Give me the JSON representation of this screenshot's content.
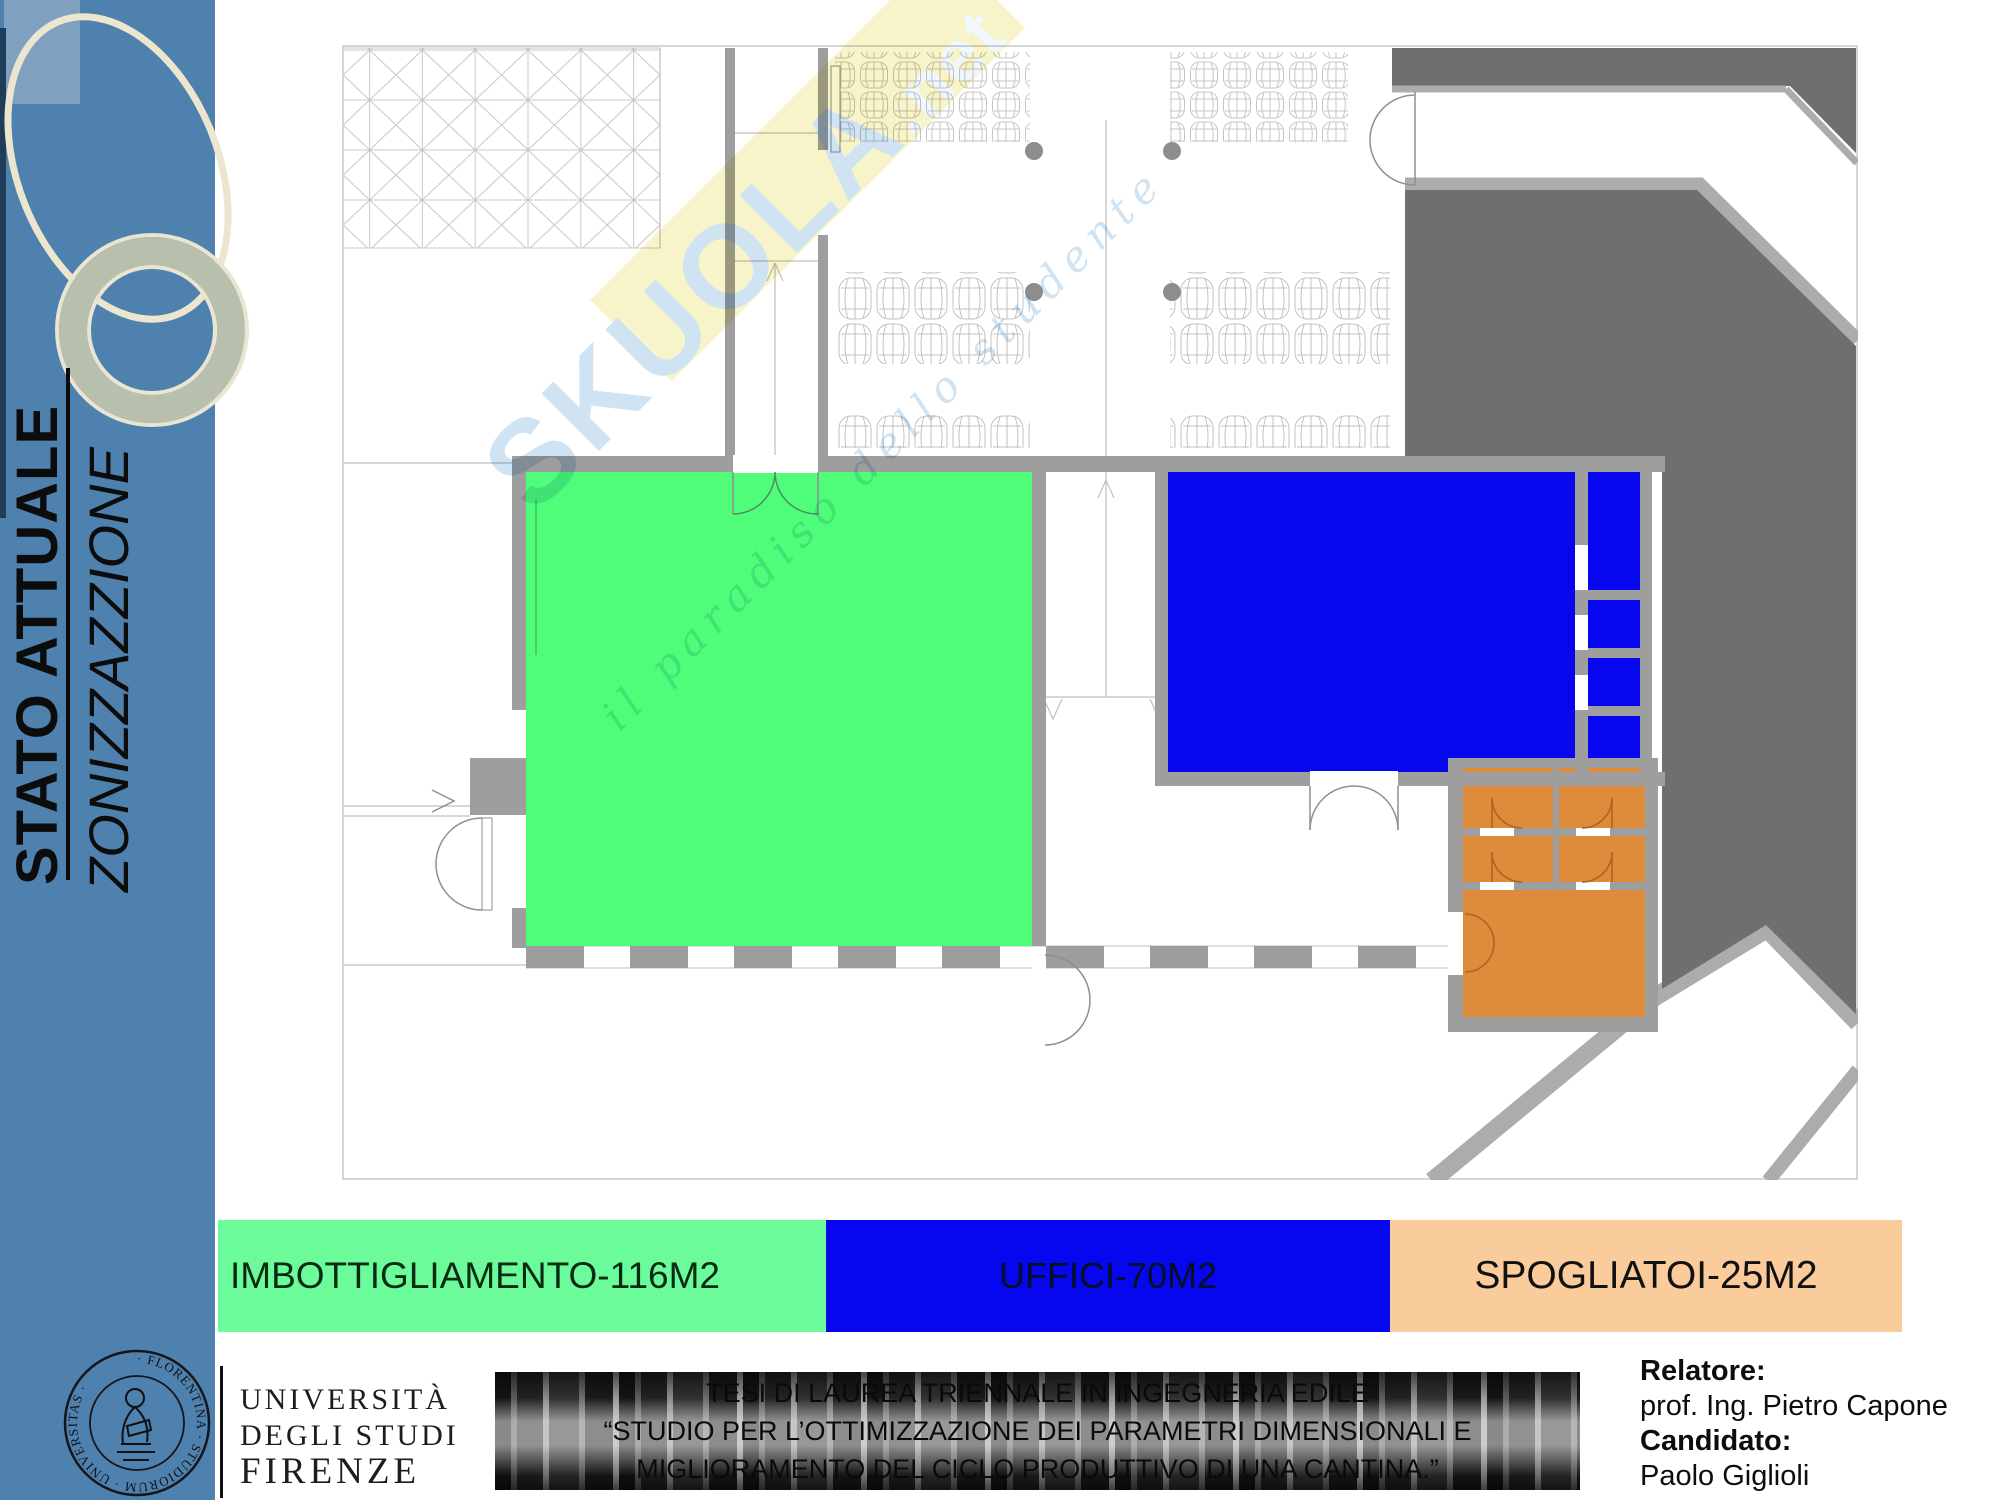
{
  "sidebar": {
    "title_main": "STATO ATTUALE",
    "title_sub": "ZONIZZAZZIONE",
    "background_color": "#4e81ae"
  },
  "watermark": {
    "brand": "SKUOLA",
    "brand_suffix": ".net",
    "tagline": "il paradiso dello studente"
  },
  "plan": {
    "zones": [
      {
        "name": "imbottigliamento",
        "color": "#50fd7a"
      },
      {
        "name": "uffici",
        "color": "#0606ef"
      },
      {
        "name": "spogliatoi",
        "color": "#de8b3c"
      }
    ],
    "wall_color": "#9e9e9e",
    "dark_area_color": "#6f6f6f"
  },
  "legend": {
    "items": [
      {
        "label": "IMBOTTIGLIAMENTO-116M2",
        "color": "#6cfb9b"
      },
      {
        "label": "UFFICI-70M2",
        "color": "#0707ef"
      },
      {
        "label": "SPOGLIATOI-25M2",
        "color": "#fbcc9b"
      }
    ]
  },
  "footer": {
    "university": {
      "line1": "UNIVERSITÀ",
      "line2": "DEGLI STUDI",
      "line3": "FIRENZE",
      "seal_ring_text": "· FLORENTINA · STUDIORUM · UNIVERSITAS ·"
    },
    "thesis": {
      "line1": "TESI DI LAUREA TRIENNALE IN INGEGNERIA EDILE",
      "line2": "“STUDIO PER L’OTTIMIZZAZIONE DEI PARAMETRI DIMENSIONALI E",
      "line3": "MIGLIORAMENTO DEL CICLO PRODUTTIVO DI UNA CANTINA.”"
    },
    "credits": {
      "relatore_label": "Relatore:",
      "relatore_name": "prof. Ing. Pietro Capone",
      "candidato_label": "Candidato:",
      "candidato_name": "Paolo Giglioli"
    }
  }
}
